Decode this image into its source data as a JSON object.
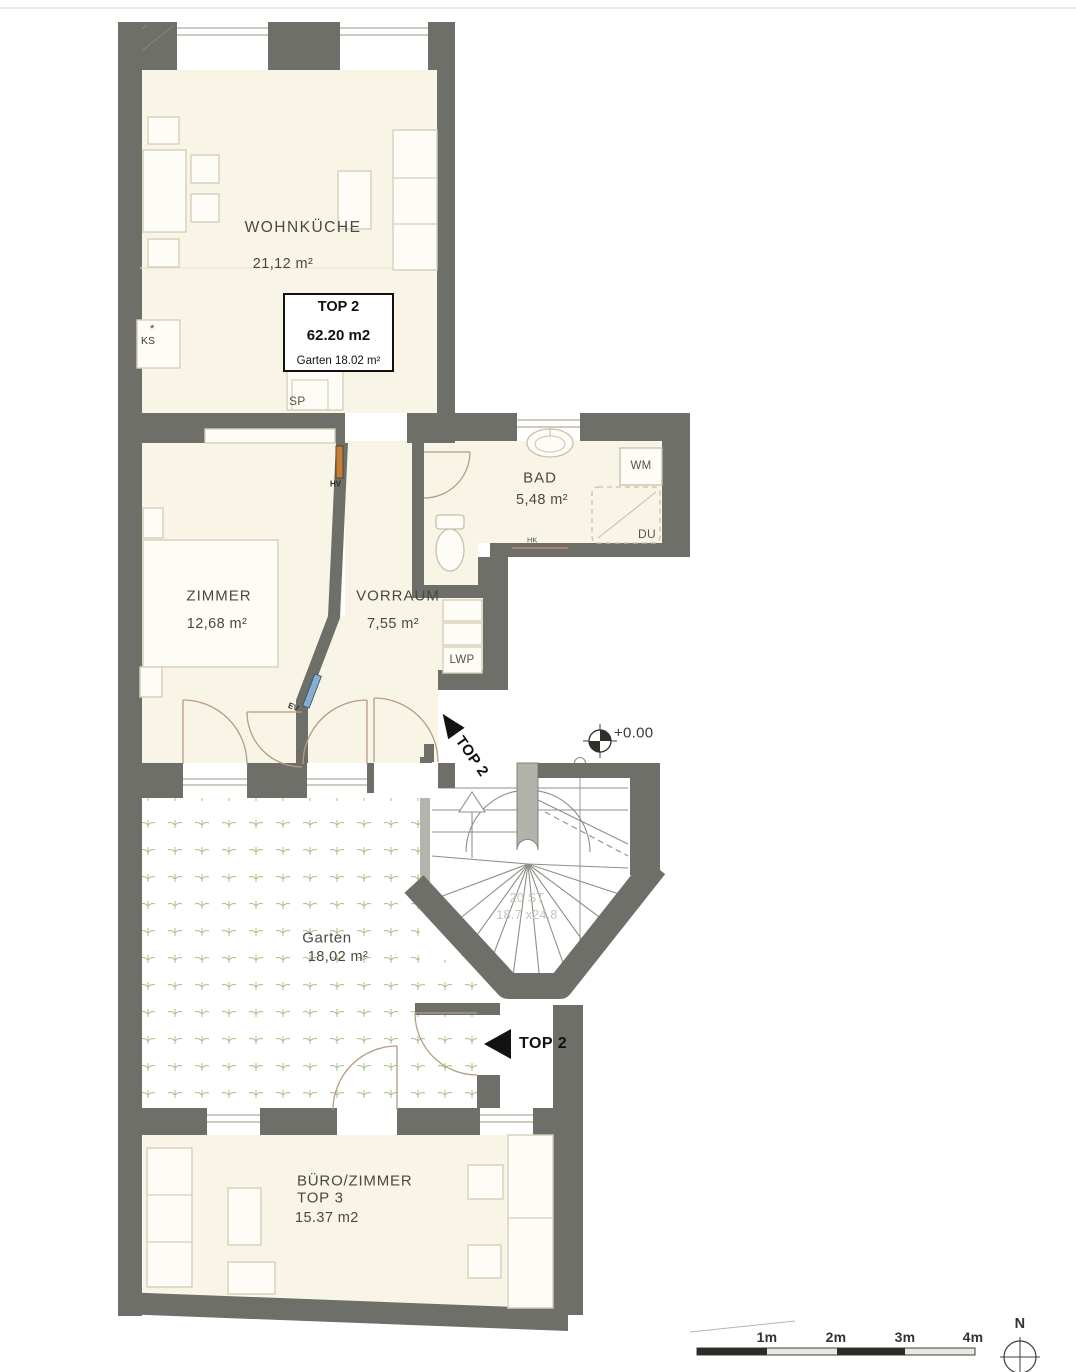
{
  "colors": {
    "wall": "#6f6f6a",
    "wall_light": "#b4b4ae",
    "room_fill": "#f9f5e6",
    "door_arc": "#b59c85",
    "garten_glyph": "#a6c289",
    "accent_black": "#121212",
    "hv_orange": "#c87f35",
    "ev_blue": "#86aecd"
  },
  "rooms": [
    {
      "id": "wohnkueche",
      "name": "WOHNKÜCHE",
      "area": "21,12 m²"
    },
    {
      "id": "zimmer",
      "name": "ZIMMER",
      "area": "12,68 m²"
    },
    {
      "id": "vorraum",
      "name": "VORRAUM",
      "area": "7,55 m²"
    },
    {
      "id": "bad",
      "name": "BAD",
      "area": "5,48 m²"
    },
    {
      "id": "garten",
      "name": "Garten",
      "area": "18,02 m²"
    },
    {
      "id": "buero",
      "name": "BÜRO/ZIMMER",
      "unit": "TOP 3",
      "area": "15.37 m2"
    }
  ],
  "unit_box": {
    "line1": "TOP 2",
    "line2": "62.20 m2",
    "line3": "Garten 18.02 m²"
  },
  "entrances": {
    "upper_label": "TOP 2",
    "lower_label": "TOP 2"
  },
  "level_marker": "+0.00",
  "stair": {
    "steps": "20 ST",
    "dimension": "18.7 x24.8"
  },
  "annotations": {
    "ks": "KS",
    "ks_mark": "*",
    "sp": "SP",
    "hv": "HV",
    "ev": "EV",
    "hk": "HK",
    "wm": "WM",
    "du": "DU",
    "lwp": "LWP"
  },
  "scale_bar": {
    "labels": [
      "1m",
      "2m",
      "3m",
      "4m"
    ]
  },
  "compass": {
    "north": "N"
  }
}
